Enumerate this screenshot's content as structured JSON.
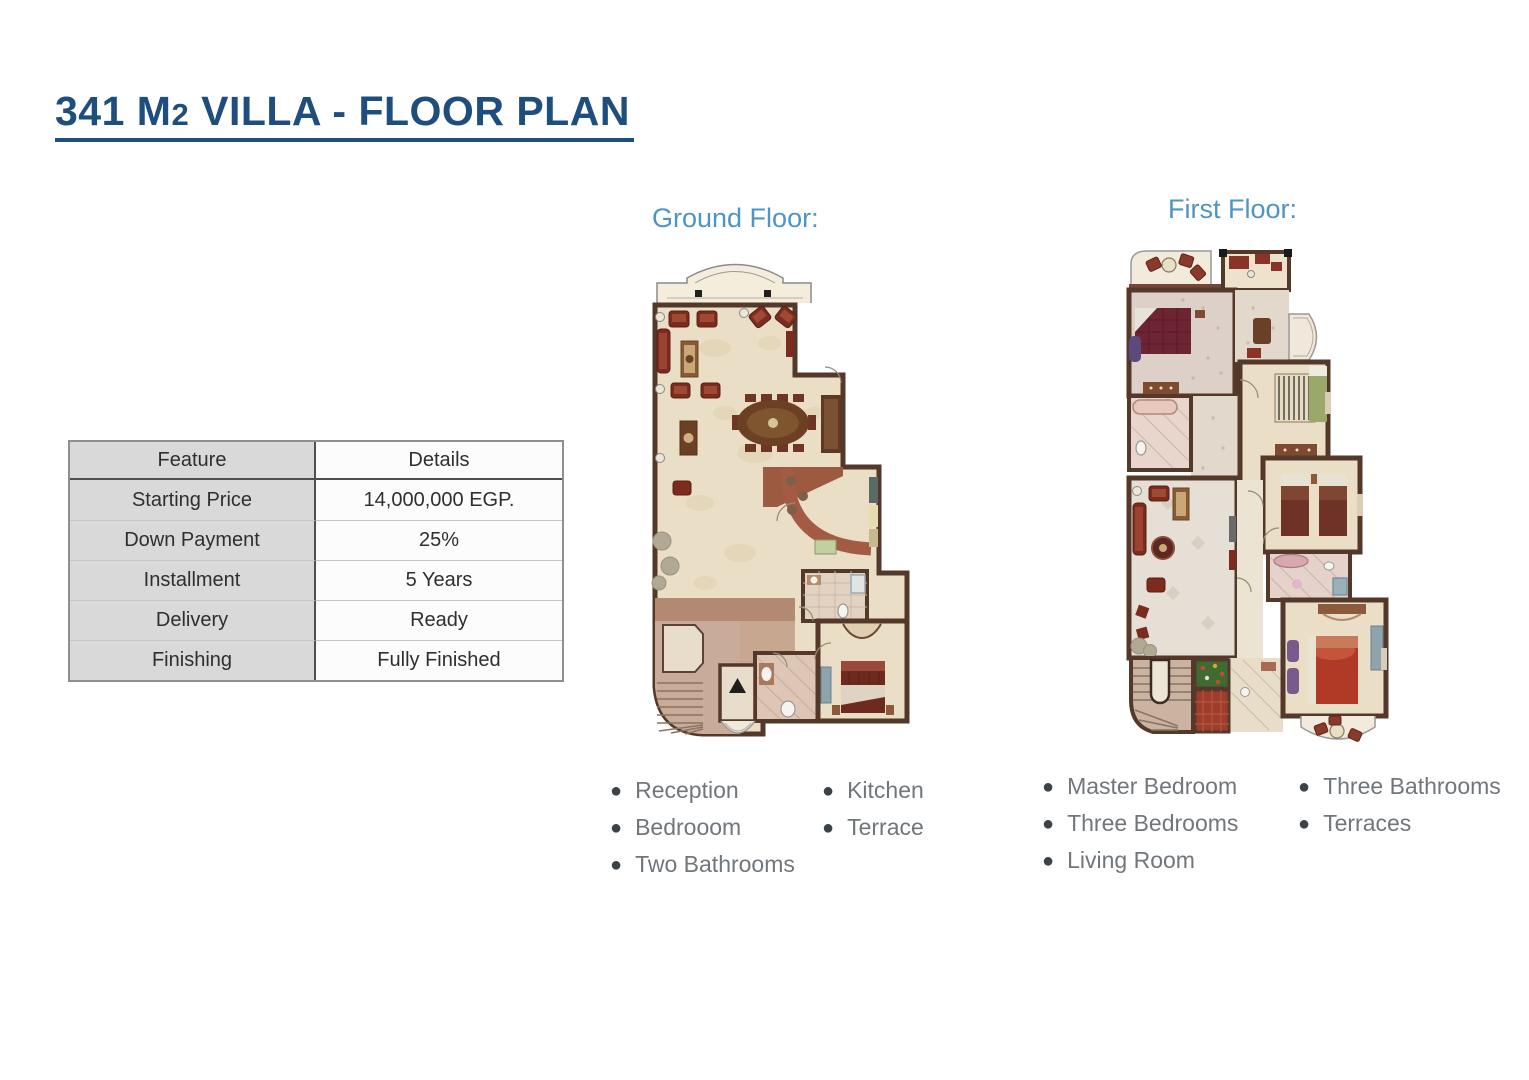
{
  "title": {
    "part1": "341 M",
    "part2": "2",
    "part3": " VILLA - FLOOR PLAN"
  },
  "table": {
    "headers": [
      "Feature",
      "Details"
    ],
    "rows": [
      {
        "feature": "Starting Price",
        "details": "14,000,000 EGP."
      },
      {
        "feature": "Down Payment",
        "details": "25%"
      },
      {
        "feature": "Installment",
        "details": "5 Years"
      },
      {
        "feature": "Delivery",
        "details": "Ready"
      },
      {
        "feature": "Finishing",
        "details": "Fully Finished"
      }
    ]
  },
  "ground_floor": {
    "label": "Ground Floor:",
    "features_col1": [
      "Reception",
      "Bedrooom",
      "Two Bathrooms"
    ],
    "features_col2": [
      "Kitchen",
      "Terrace"
    ]
  },
  "first_floor": {
    "label": "First Floor:",
    "features_col1": [
      "Master Bedroom",
      "Three Bedrooms",
      "Living Room"
    ],
    "features_col2": [
      "Three Bathrooms",
      "Terraces"
    ]
  },
  "palette": {
    "titleColor": "#1d4e7d",
    "floorLabelColor": "#4e95c5",
    "bulletTextColor": "#70767b",
    "tableHeaderBg": "#b3b3b3",
    "tableFeatureBg": "#d9d9d9",
    "tableDetailsBg": "#fcfcfc",
    "tableBorderDark": "#4f4f4f",
    "planWall": "#54392a",
    "planFloorCream": "#eadfc6",
    "planFurnitureRed": "#7c2b1f",
    "planCounterTerracotta": "#a35c43",
    "planHallPink": "#c3a28f"
  }
}
